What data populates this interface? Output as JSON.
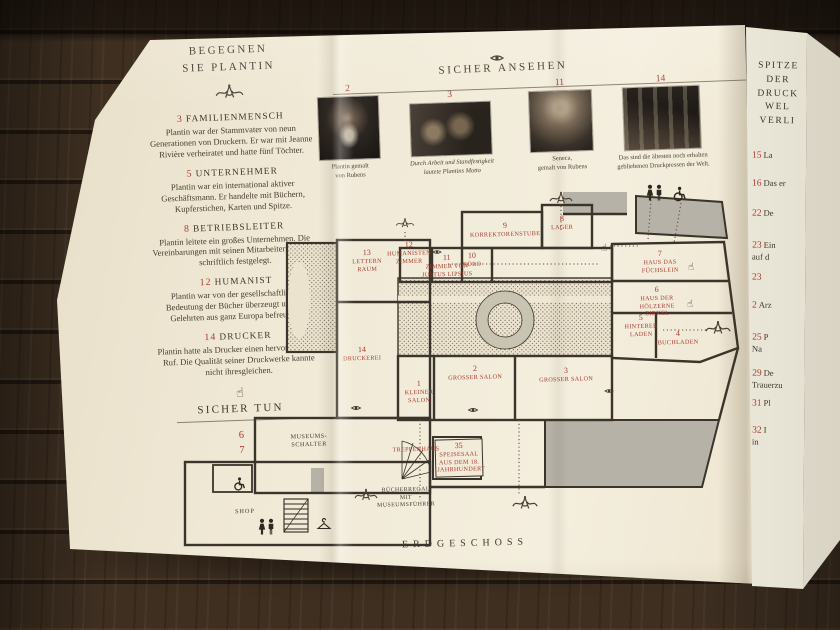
{
  "accent_color": "#a93b2e",
  "icons": {
    "hand": "☝"
  },
  "left_column": {
    "title": "BEGEGNEN\nSIE PLANTIN",
    "items": [
      {
        "number": "3",
        "heading": "FAMILIENMENSCH",
        "body": "Plantin war der Stammvater von neun Generationen von Druckern. Er war mit Jeanne Rivière verheiratet und hatte fünf Töchter."
      },
      {
        "number": "5",
        "heading": "UNTERNEHMER",
        "body": "Plantin war ein international aktiver Geschäftsmann. Er handelte mit Büchern, Kupferstichen, Karten und Spitze."
      },
      {
        "number": "8",
        "heading": "BETRIEBSLEITER",
        "body": "Plantin leitete ein großes Unternehmen. Die Vereinbarungen mit seinen Mitarbeitern wurden schriftlich festgelegt."
      },
      {
        "number": "12",
        "heading": "HUMANIST",
        "body": "Plantin war von der gesellschaftlichen Bedeutung der Bücher überzeugt und mit Gelehrten aus ganz Europa befreundet."
      },
      {
        "number": "14",
        "heading": "DRUCKER",
        "body": "Plantin hatte als Drucker einen hervorragenden Ruf. Die Qualität seiner Druckwerke kannte nicht ihresgleichen."
      }
    ],
    "sicher_tun_title": "SICHER TUN",
    "sicher_tun_numbers": [
      "6",
      "7"
    ]
  },
  "gallery": {
    "title": "SICHER ANSEHEN",
    "figures": [
      {
        "number": "2",
        "caption": "Plantin gemalt\nvon Rubens"
      },
      {
        "number": "3",
        "caption": "Durch Arbeit und Standfestigkeit\nlautete Plantins Motto"
      },
      {
        "number": "11",
        "caption": "Seneca,\ngemalt von Rubens"
      },
      {
        "number": "14",
        "caption": "Das sind die ältesten noch erhalten\ngebliebenen Druckpressen der Welt."
      }
    ]
  },
  "plan": {
    "floor_caption": "ERDGESCHOSS",
    "rooms": [
      {
        "number": "13",
        "name": "LETTERN\nRAUM"
      },
      {
        "number": "12",
        "name": "HUMANISTEN\nZIMMER"
      },
      {
        "number": "11",
        "name": "ZIMMER VON\nJUSTUS LIPSIUS"
      },
      {
        "number": "10",
        "name": "BÜRO"
      },
      {
        "number": "9",
        "name": "KORREKTORENSTUBE"
      },
      {
        "number": "8",
        "name": "LAGER"
      },
      {
        "number": "7",
        "name": "HAUS DAS FÜCHSLEIN"
      },
      {
        "number": "6",
        "name": "HAUS DER HÖLZERNE\nZIRKEL"
      },
      {
        "number": "5",
        "name": "HINTERER\nLADEN"
      },
      {
        "number": "4",
        "name": "BUCHLADEN"
      },
      {
        "number": "2",
        "name": "GROSSER SALON"
      },
      {
        "number": "3",
        "name": "GROSSER SALON"
      },
      {
        "number": "1",
        "name": "KLEINER\nSALON"
      },
      {
        "number": "14",
        "name": "DRUCKEREI"
      },
      {
        "number": "35",
        "name": "SPEISESAAL\nAUS DEM 18.\nJAHRHUNDERT"
      }
    ],
    "treppenhaus_label": "TREPPENHAUS",
    "museum_desk_label": "MUSEUMS-\nSCHALTER",
    "shop_label": "SHOP",
    "bookshelf_label": "BÜCHERREGAL MIT\nMUSEUMSFÜHRER"
  },
  "right_column": {
    "heading": "SPITZE\nDER\nDRUCK\nWEL\nVERLI",
    "entries": [
      {
        "number": "15",
        "text": "La"
      },
      {
        "number": "16",
        "text": "Das er"
      },
      {
        "number": "22",
        "text": "De"
      },
      {
        "number": "23",
        "text": "Ein\nauf d"
      },
      {
        "number": "23",
        "text": ""
      },
      {
        "number": "2",
        "text": "Arz"
      },
      {
        "number": "25",
        "text": "P\nNa"
      },
      {
        "number": "29",
        "text": "De\nTrauerzu"
      },
      {
        "number": "31",
        "text": "Pl"
      },
      {
        "number": "32",
        "text": "I\nin"
      }
    ]
  }
}
